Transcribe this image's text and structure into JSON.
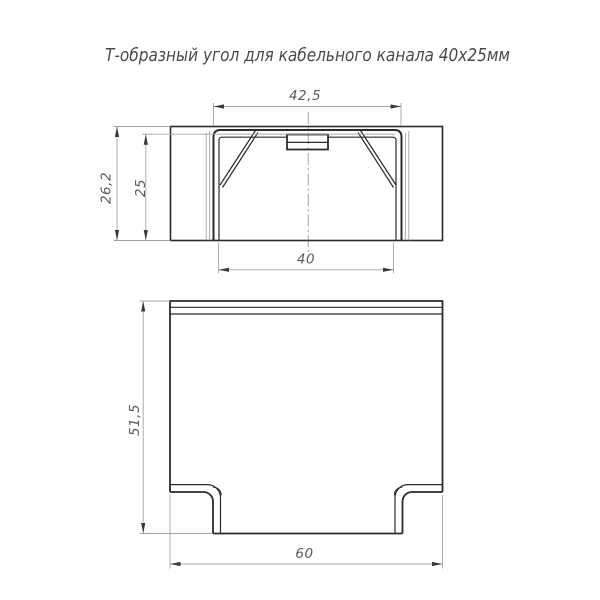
{
  "title": "Т-образный угол для кабельного канала 40х25мм",
  "drawing": {
    "front_view": {
      "dimensions": {
        "cover_width": "42,5",
        "overall_height": "26,2",
        "channel_height": "25",
        "channel_width": "40"
      }
    },
    "plan_view": {
      "dimensions": {
        "overall_depth": "51,5",
        "overall_width": "60"
      }
    }
  },
  "colors": {
    "background": "#ffffff",
    "object_line": "#2b2b2b",
    "aux_line": "#a3a3a3",
    "dimension_text": "#5a5a5a",
    "title_text": "#4a4a4a"
  }
}
